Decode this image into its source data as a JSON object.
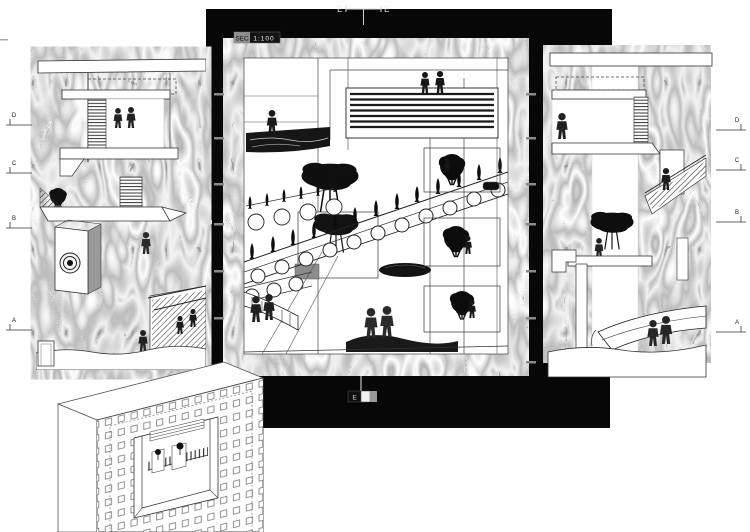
{
  "colors": {
    "paper": "#ffffff",
    "frame_black": "#070707",
    "moire_gray": "#8e8e8e",
    "ink": "#1a1a1a"
  },
  "scale_badge": {
    "prefix": "SEC",
    "value": "1:100"
  },
  "markers": {
    "top": {
      "left": "E",
      "right": "E"
    },
    "bottom": {
      "label": "E"
    },
    "left_levels": [
      {
        "label": "D"
      },
      {
        "label": "C"
      },
      {
        "label": "B"
      },
      {
        "label": "A"
      }
    ],
    "right_levels": [
      {
        "label": "D"
      },
      {
        "label": "C"
      },
      {
        "label": "B"
      },
      {
        "label": "A"
      }
    ]
  }
}
